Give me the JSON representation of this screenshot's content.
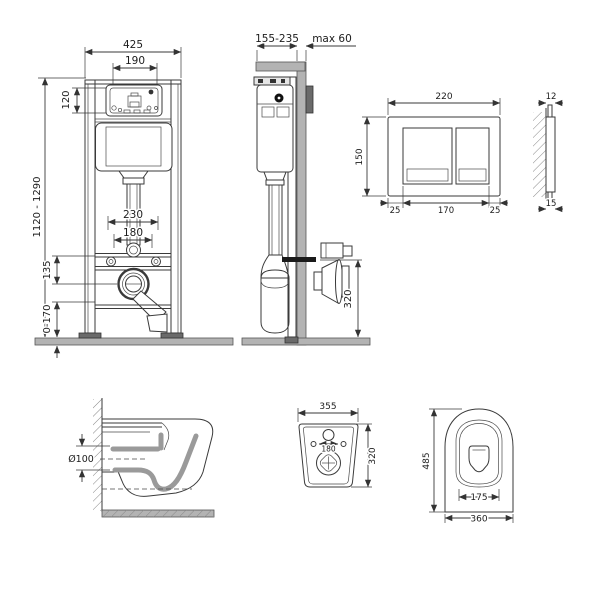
{
  "meta": {
    "background": "#ffffff",
    "line_color": "#3a3a3a",
    "wall_gray": "#b3b3b3",
    "plate_dark_gray": "#6a6a6a"
  },
  "figures": {
    "frame_front": {
      "dims": {
        "overall_width": "425",
        "tank_window_width": "190",
        "panel_height": "120",
        "frame_height": "1120 - 1290",
        "fixing_spacing_wide": "230",
        "fixing_spacing_narrow": "180",
        "outlet_offset": "135",
        "feet_adjust_range": "0-170"
      }
    },
    "frame_side": {
      "dims": {
        "depth_range": "155-235",
        "wall_thickness_max": "max 60",
        "outlet_height": "320"
      }
    },
    "plate_front": {
      "dims": {
        "width": "220",
        "height": "150",
        "margin_left": "25",
        "buttons_width": "170",
        "margin_right": "25"
      }
    },
    "plate_side": {
      "dims": {
        "protrusion_top": "12",
        "protrusion_bottom": "15"
      }
    },
    "bowl_side": {
      "dims": {
        "outlet_diameter": "Ø100"
      }
    },
    "bowl_back": {
      "dims": {
        "width": "355",
        "hole_spacing": "180",
        "height": "320"
      }
    },
    "bowl_top": {
      "dims": {
        "depth": "485",
        "seat_opening_width": "175",
        "width": "360"
      }
    }
  }
}
